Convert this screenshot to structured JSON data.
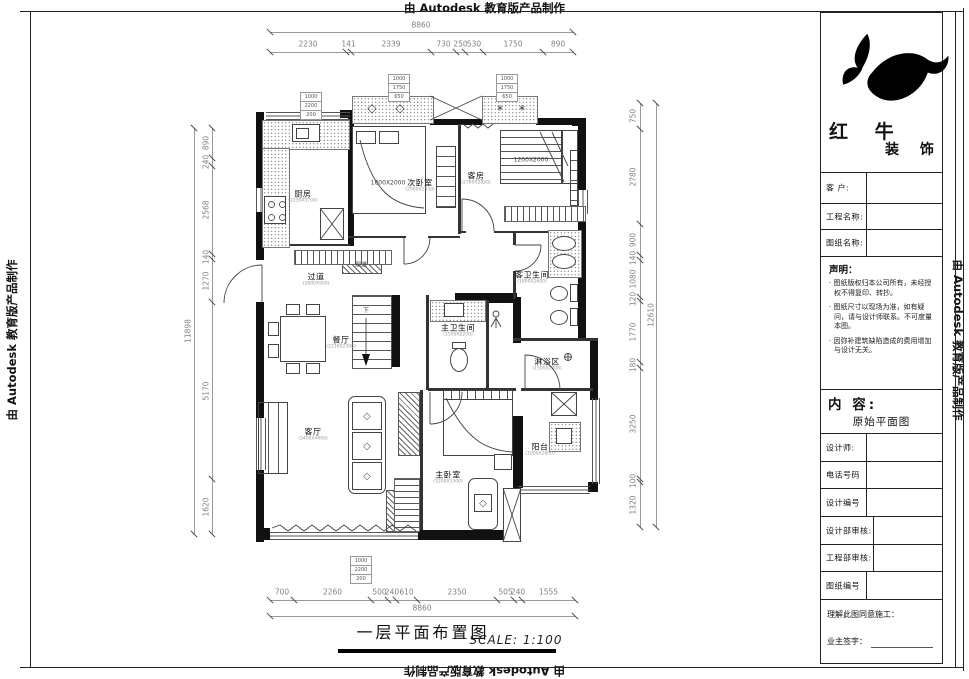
{
  "edge_text": "由 Autodesk 教育版产品制作",
  "footer": {
    "title": "一层平面布置图",
    "scale": "SCALE: 1:100"
  },
  "title_block": {
    "brand_line1": "红 牛",
    "brand_line2": "装 饰",
    "customer_label": "客  户:",
    "project_label": "工程名称:",
    "drawing_label": "图纸名称:",
    "statement_title": "声明：",
    "statement_items": [
      "图纸版权归本公司所有，未经授权不得复印、转抄。",
      "图纸尺寸以现场为准，如有疑问，请与设计师联系。不可度量本图。",
      "因弥补建筑缺陷造成的费用增加与设计无关。"
    ],
    "content_label": "内 容:",
    "content_value": "原始平面图",
    "designer_label": "设计师:",
    "phone_label": "电话号码",
    "design_no_label": "设计编号",
    "design_review_label": "设计部审核:",
    "eng_review_label": "工程部审核:",
    "drawing_no_label": "图纸编号",
    "agree_label": "理解此图同意施工：",
    "owner_sign_label": "业主签字："
  },
  "plan": {
    "rooms": [
      {
        "id": "kitchen",
        "name": "厨房",
        "sub": "(2230X3700)"
      },
      {
        "id": "bedroom2",
        "name": "次卧室",
        "sub": "(2900X2339)"
      },
      {
        "id": "guest",
        "name": "客房",
        "sub": "(2780X2850)"
      },
      {
        "id": "hallway",
        "name": "过道",
        "sub": "(2600X900)"
      },
      {
        "id": "dining",
        "name": "餐厅",
        "sub": "(2230X2300)"
      },
      {
        "id": "living",
        "name": "客厅",
        "sub": "(3400X4400)"
      },
      {
        "id": "master",
        "name": "主卧室",
        "sub": "(3200X3300)"
      },
      {
        "id": "mbath",
        "name": "主卫生间",
        "sub": "(1500X2200)"
      },
      {
        "id": "gbath",
        "name": "客卫生间",
        "sub": "(1800X2600)"
      },
      {
        "id": "shower",
        "name": "淋浴区",
        "sub": "(1500X1200)"
      },
      {
        "id": "balcony",
        "name": "阳台",
        "sub": "(1000X2800)"
      }
    ],
    "annotations": [
      {
        "id": "bed2_size",
        "text": "1800X2000"
      },
      {
        "id": "guestbed_size",
        "text": "1200X2000"
      },
      {
        "id": "stair_down",
        "text": "下"
      },
      {
        "id": "duct",
        "text": "烟道"
      }
    ]
  },
  "dimensions": {
    "top": {
      "overall": "8860",
      "segments": [
        "2230",
        "141",
        "2339",
        "730",
        "250",
        "530",
        "1750",
        "890"
      ]
    },
    "bottom": {
      "overall": "8860",
      "segments": [
        "700",
        "2260",
        "500",
        "240",
        "610",
        "2350",
        "505",
        "240",
        "1555"
      ]
    },
    "left": {
      "overall": "11898",
      "segments": [
        "890",
        "240",
        "2568",
        "140",
        "1270",
        "5170",
        "1620"
      ]
    },
    "right": {
      "overall": "12610",
      "segments": [
        "750",
        "2780",
        "900",
        "140",
        "1080",
        "120",
        "1770",
        "180",
        "3250",
        "100",
        "1320"
      ]
    },
    "stacks": [
      {
        "values": [
          "1000",
          "2200",
          "200"
        ]
      },
      {
        "values": [
          "1000",
          "1750",
          "650"
        ]
      },
      {
        "values": [
          "1000",
          "1750",
          "650"
        ]
      },
      {
        "values": [
          "1000",
          "2200",
          "200"
        ]
      }
    ]
  }
}
